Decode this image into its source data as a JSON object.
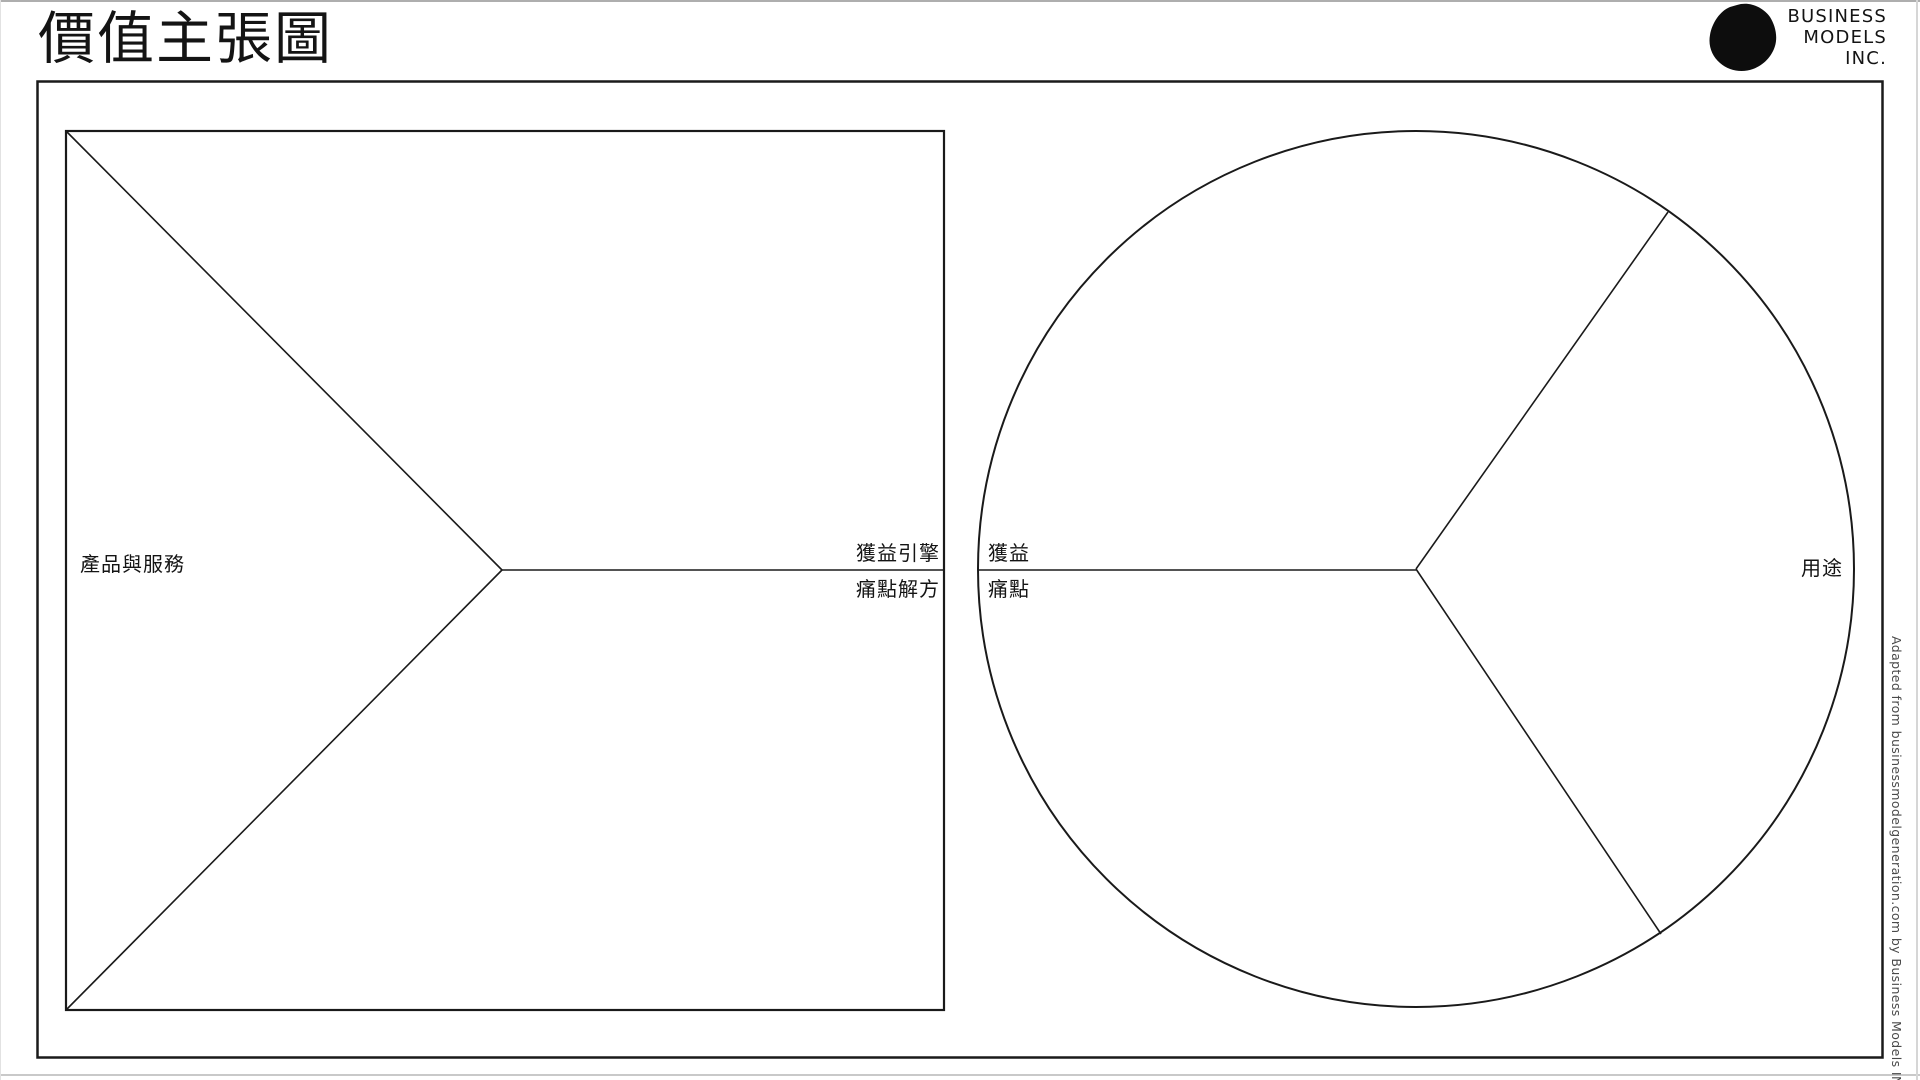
{
  "page": {
    "title": "價值主張圖",
    "background_color": "#ffffff",
    "line_color": "#1a1a1a"
  },
  "logo": {
    "company": "Business Models Inc.",
    "mark_icon": "blob-icon",
    "lines": [
      "BUSINESS",
      "MODELS",
      "INC."
    ]
  },
  "value_map": {
    "shape": "square",
    "products_services_label": "產品與服務",
    "gain_creators_label": "獲益引擎",
    "pain_relievers_label": "痛點解方"
  },
  "customer_profile": {
    "shape": "circle",
    "gains_label": "獲益",
    "pains_label": "痛點",
    "jobs_label": "用途"
  },
  "attribution": "Adapted from businessmodelgeneration.com by Business Models INC."
}
